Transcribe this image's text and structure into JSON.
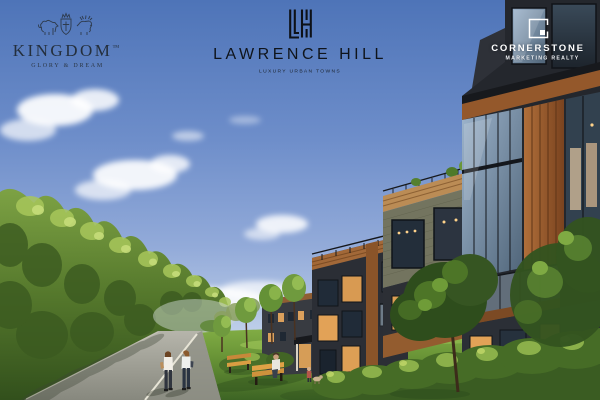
{
  "canvas": {
    "width": 600,
    "height": 400
  },
  "branding": {
    "kingdom": {
      "name": "KINGDOM",
      "trademark": "™",
      "tagline": "GLORY & DREAM",
      "icon": "kingdom-crest-icon",
      "text_color": "#242f3d"
    },
    "lawrence_hill": {
      "name": "LAWRENCE HILL",
      "tagline": "LUXURY URBAN TOWNS",
      "icon": "lawrence-hill-monogram-icon",
      "text_color": "#10161e"
    },
    "cornerstone": {
      "name": "CORNERSTONE",
      "tagline": "MARKETING REALTY",
      "icon": "cornerstone-square-mark-icon",
      "text_color": "#ffffff"
    }
  },
  "scene": {
    "subject": "Dusk architectural rendering of modern four-storey wood and charcoal-brick urban towns with glass balconies and planted terraces beside a tree-lined walking path, lawn, benches and residents",
    "palette": {
      "sky_top": "#4e74b8",
      "sky_horizon": "#e2ebf5",
      "cloud": "#ffffff",
      "tree_light": "#a8c75b",
      "tree_mid": "#74983c",
      "tree_dark": "#32501c",
      "lawn_light": "#8cb84b",
      "lawn_dark": "#3d6424",
      "hedge": "#466c26",
      "path_light": "#b6b5ab",
      "path_dark": "#87887e",
      "path_line": "#ece9db",
      "facade_charcoal": "#2b2e35",
      "facade_olive_brick": "#73745f",
      "wood_cladding": "#a26838",
      "wood_light": "#bb8c55",
      "glass_blue": "#9db4cc",
      "window_dark": "#202b38",
      "window_warm": "#e2a257",
      "bench_wood": "#d99d42"
    }
  }
}
